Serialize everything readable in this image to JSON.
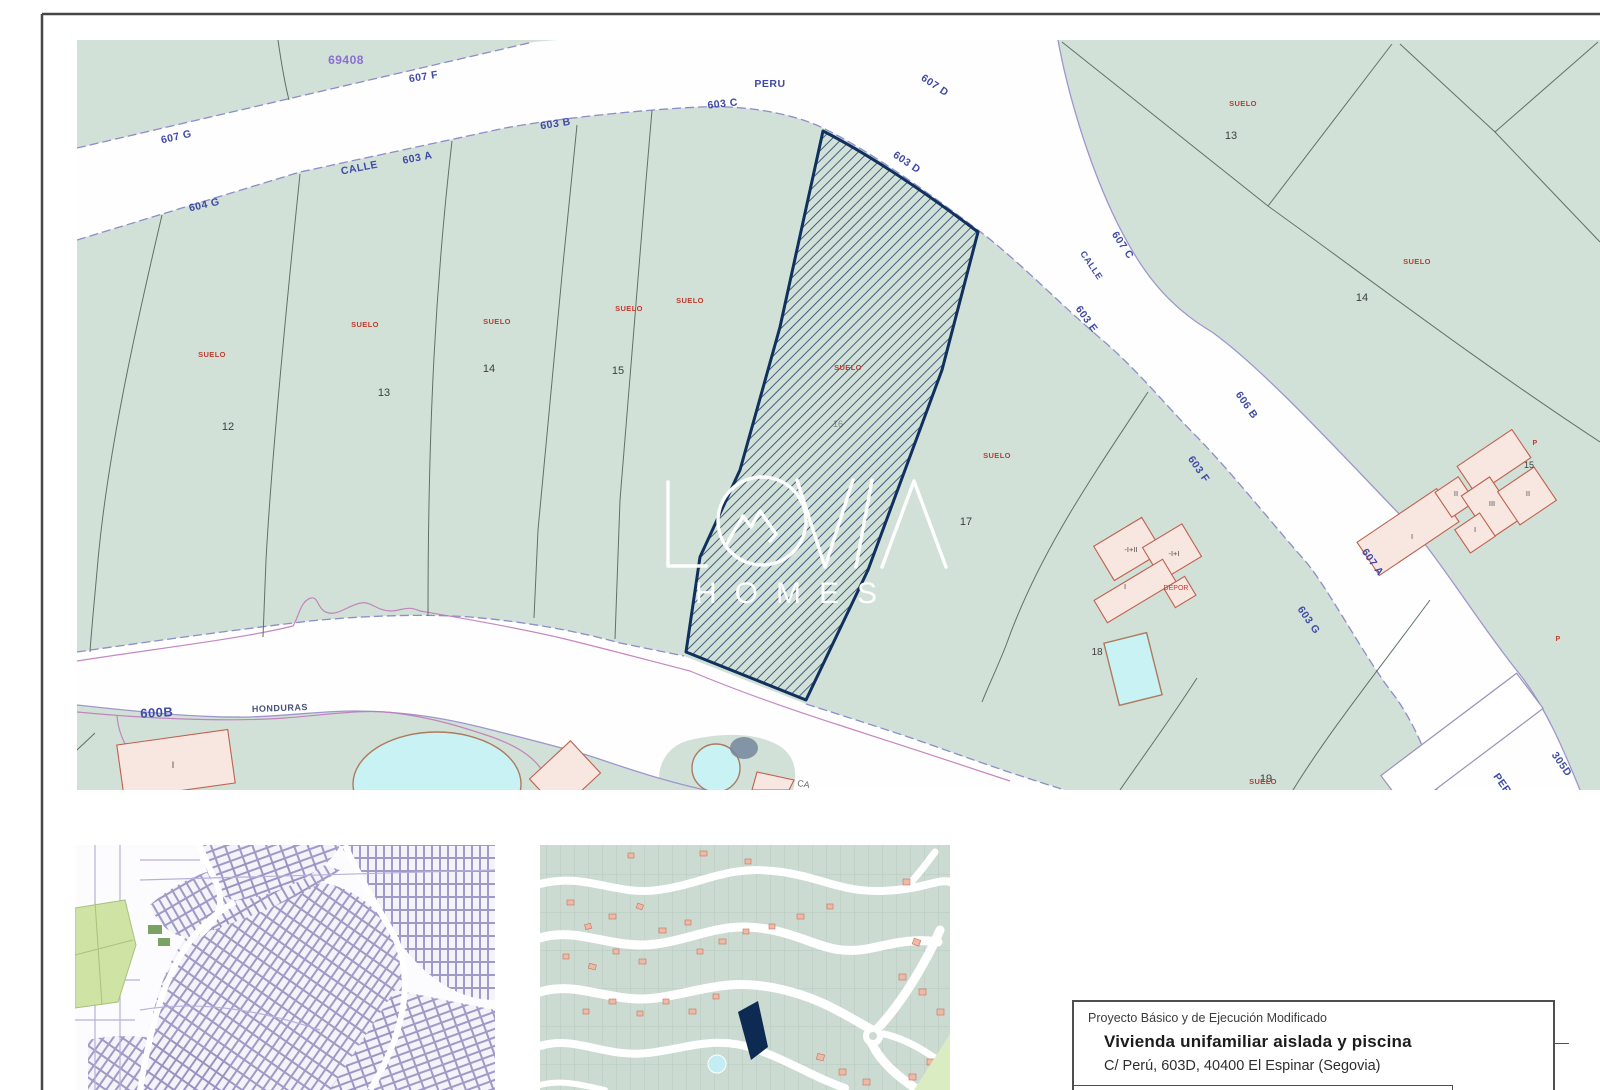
{
  "colors": {
    "navy": "#10305e",
    "hatch": "#274572",
    "suelo-red": "#c13a2c",
    "street-blue": "#3f4aa8",
    "sage": "#d2e1d8",
    "pink-fill": "#f8e7e1",
    "pink-stroke": "#c0604d",
    "pool": "#c9f2f5",
    "edge-purple": "#9e96ce",
    "contour": "#c07ab8",
    "bound": "#5d7265"
  },
  "watermark": {
    "brand": "LOVIA",
    "word": "HOMES"
  },
  "title_block": {
    "line1": "Proyecto Básico y de Ejecución Modificado",
    "line2": "Vivienda unifamiliar aislada y piscina",
    "line3": "C/ Perú, 603D, 40400 El Espinar  (Segovia)"
  },
  "map_labels": {
    "street": [
      {
        "t": "607 G",
        "x": 177,
        "y": 140,
        "r": -13
      },
      {
        "t": "604 G",
        "x": 205,
        "y": 208,
        "r": -13
      },
      {
        "t": "CALLE",
        "x": 360,
        "y": 171,
        "r": -11
      },
      {
        "t": "603 A",
        "x": 418,
        "y": 161,
        "r": -11
      },
      {
        "t": "607 F",
        "x": 424,
        "y": 80,
        "r": -9
      },
      {
        "t": "69408",
        "x": 346,
        "y": 64,
        "r": 0,
        "c": "#8a6fd0",
        "s": 12
      },
      {
        "t": "603 B",
        "x": 556,
        "y": 127,
        "r": -9
      },
      {
        "t": "603 C",
        "x": 723,
        "y": 107,
        "r": -6
      },
      {
        "t": "PERU",
        "x": 770,
        "y": 87,
        "r": 0
      },
      {
        "t": "607 D",
        "x": 933,
        "y": 88,
        "r": 34
      },
      {
        "t": "603 D",
        "x": 905,
        "y": 165,
        "r": 34
      },
      {
        "t": "607 C",
        "x": 1120,
        "y": 247,
        "r": 56
      },
      {
        "t": "CALLE",
        "x": 1089,
        "y": 267,
        "r": 56,
        "s": 9
      },
      {
        "t": "603 E",
        "x": 1084,
        "y": 321,
        "r": 54
      },
      {
        "t": "606 B",
        "x": 1244,
        "y": 407,
        "r": 55
      },
      {
        "t": "603 F",
        "x": 1196,
        "y": 471,
        "r": 55
      },
      {
        "t": "607 A",
        "x": 1370,
        "y": 564,
        "r": 55
      },
      {
        "t": "603 G",
        "x": 1306,
        "y": 622,
        "r": 55
      },
      {
        "t": "PERU",
        "x": 1502,
        "y": 789,
        "r": 55
      },
      {
        "t": "305D",
        "x": 1559,
        "y": 766,
        "r": 55
      },
      {
        "t": "600B",
        "x": 157,
        "y": 717,
        "r": -3,
        "s": 13
      },
      {
        "t": "HONDURAS",
        "x": 280,
        "y": 711,
        "r": -2,
        "s": 9,
        "c": "#475379"
      }
    ],
    "parcel": [
      {
        "t": "12",
        "x": 228,
        "y": 430
      },
      {
        "t": "13",
        "x": 384,
        "y": 396
      },
      {
        "t": "14",
        "x": 489,
        "y": 372
      },
      {
        "t": "15",
        "x": 618,
        "y": 374
      },
      {
        "t": "16",
        "x": 838,
        "y": 427,
        "s": 9,
        "o": 0.55
      },
      {
        "t": "17",
        "x": 966,
        "y": 525
      },
      {
        "t": "18",
        "x": 1097,
        "y": 655,
        "s": 10
      },
      {
        "t": "19",
        "x": 1266,
        "y": 782
      },
      {
        "t": "13",
        "x": 1231,
        "y": 139
      },
      {
        "t": "14",
        "x": 1362,
        "y": 301
      },
      {
        "t": "15",
        "x": 1529,
        "y": 468,
        "s": 9
      }
    ],
    "suelo": [
      {
        "t": "SUELO",
        "x": 212,
        "y": 357
      },
      {
        "t": "SUELO",
        "x": 365,
        "y": 327
      },
      {
        "t": "SUELO",
        "x": 497,
        "y": 324
      },
      {
        "t": "SUELO",
        "x": 629,
        "y": 311
      },
      {
        "t": "SUELO",
        "x": 690,
        "y": 303
      },
      {
        "t": "SUELO",
        "x": 848,
        "y": 370
      },
      {
        "t": "SUELO",
        "x": 997,
        "y": 458
      },
      {
        "t": "SUELO",
        "x": 1243,
        "y": 106
      },
      {
        "t": "SUELO",
        "x": 1417,
        "y": 264
      },
      {
        "t": "SUELO",
        "x": 1263,
        "y": 784
      },
      {
        "t": "P",
        "x": 1535,
        "y": 445,
        "s": 7
      },
      {
        "t": "P",
        "x": 1558,
        "y": 641,
        "s": 7
      }
    ],
    "building": [
      {
        "t": "I",
        "x": 1412,
        "y": 539
      },
      {
        "t": "II",
        "x": 1456,
        "y": 496
      },
      {
        "t": "III",
        "x": 1492,
        "y": 506
      },
      {
        "t": "II",
        "x": 1528,
        "y": 496
      },
      {
        "t": "I",
        "x": 1475,
        "y": 532
      },
      {
        "t": "-I+II",
        "x": 1131,
        "y": 552
      },
      {
        "t": "-I+I",
        "x": 1174,
        "y": 556
      },
      {
        "t": "I",
        "x": 1125,
        "y": 589
      },
      {
        "t": "DEPOR",
        "x": 1176,
        "y": 590,
        "c": "#c13a2c",
        "s": 7
      },
      {
        "t": "I",
        "x": 173,
        "y": 768,
        "s": 9
      },
      {
        "t": "CA",
        "x": 803,
        "y": 787,
        "c": "#6b6b6b",
        "s": 9,
        "r": 10
      }
    ]
  }
}
